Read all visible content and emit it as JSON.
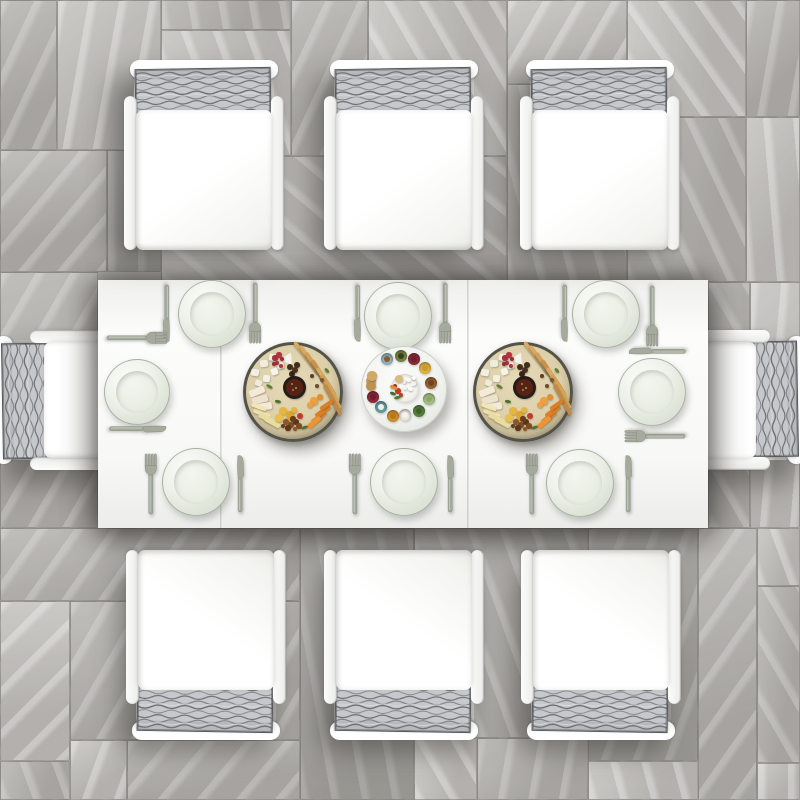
{
  "alt": "Top-down photo of a white aluminum outdoor dining set on gray stone tile: rectangular white table, eight chairs with white seat cushions and gray woven back cushions, eight pale sage dinner plates with forks and knives, two round charcuterie boards and a central snack platter with small bowls",
  "palette": {
    "floor_light": "#c1bfbb",
    "floor_mid": "#b2b0ac",
    "floor_dark": "#a19f9b",
    "seam": "#767470",
    "table_white": "#f8f8f6",
    "chair_white": "#fcfcfa",
    "cushion_gray": "#c4c6c9",
    "cushion_line": "#6a6d72",
    "plate_sage": "#e3e8dd",
    "cutlery_metal": "#a5aa9d",
    "board_rim": "#53534a",
    "breadstick": "#d9aa63",
    "cheese_white": "#f2efe4",
    "berry_red": "#a83040",
    "date_brown": "#422b1b",
    "chutney": "#5a2115",
    "dried_yellow": "#e5b53e",
    "nut_brown": "#7c4b24",
    "carrot_orange": "#e78a2d",
    "leaf_green": "#5d7c36"
  },
  "floor": {
    "tiles": [
      [
        0,
        0,
        57,
        150,
        1,
        115
      ],
      [
        57,
        0,
        104,
        150,
        0,
        100
      ],
      [
        161,
        0,
        130,
        30,
        1,
        80
      ],
      [
        161,
        30,
        130,
        126,
        0,
        70
      ],
      [
        291,
        0,
        77,
        156,
        1,
        115
      ],
      [
        368,
        0,
        139,
        156,
        0,
        60
      ],
      [
        0,
        150,
        107,
        122,
        1,
        130
      ],
      [
        107,
        150,
        54,
        122,
        2,
        90
      ],
      [
        161,
        156,
        346,
        126,
        1,
        40
      ],
      [
        507,
        0,
        120,
        84,
        0,
        120
      ],
      [
        507,
        84,
        120,
        198,
        1,
        75
      ],
      [
        627,
        0,
        119,
        117,
        0,
        55
      ],
      [
        746,
        0,
        54,
        117,
        1,
        100
      ],
      [
        627,
        117,
        119,
        165,
        1,
        65
      ],
      [
        746,
        117,
        54,
        165,
        0,
        85
      ],
      [
        0,
        272,
        98,
        256,
        1,
        120
      ],
      [
        708,
        282,
        42,
        246,
        1,
        60
      ],
      [
        750,
        282,
        50,
        246,
        0,
        95
      ],
      [
        0,
        528,
        300,
        73,
        1,
        125
      ],
      [
        300,
        528,
        114,
        272,
        2,
        80
      ],
      [
        414,
        528,
        174,
        210,
        1,
        70
      ],
      [
        588,
        528,
        110,
        233,
        2,
        110
      ],
      [
        698,
        528,
        59,
        272,
        1,
        125
      ],
      [
        757,
        528,
        43,
        58,
        0,
        70
      ],
      [
        757,
        586,
        43,
        177,
        1,
        60
      ],
      [
        757,
        763,
        43,
        37,
        0,
        90
      ],
      [
        0,
        601,
        70,
        160,
        0,
        135
      ],
      [
        70,
        601,
        230,
        139,
        1,
        120
      ],
      [
        0,
        761,
        70,
        39,
        1,
        70
      ],
      [
        70,
        740,
        57,
        60,
        0,
        110
      ],
      [
        127,
        740,
        173,
        60,
        1,
        130
      ],
      [
        414,
        738,
        63,
        62,
        0,
        60
      ],
      [
        477,
        738,
        111,
        62,
        1,
        100
      ],
      [
        588,
        761,
        110,
        39,
        0,
        75
      ]
    ]
  },
  "table": {
    "x": 98,
    "y": 280,
    "w": 610,
    "h": 248,
    "seam_offsets": [
      122,
      369
    ]
  },
  "chairs": {
    "top": [
      {
        "x": 124,
        "y": 60,
        "sh": [
          -16,
          12
        ]
      },
      {
        "x": 324,
        "y": 60,
        "sh": [
          -12,
          12
        ]
      },
      {
        "x": 520,
        "y": 60,
        "sh": [
          -14,
          12
        ]
      }
    ],
    "bottom": [
      {
        "x": 126,
        "y": 548,
        "sh": [
          -10,
          -16
        ]
      },
      {
        "x": 324,
        "y": 548,
        "sh": [
          -8,
          -16
        ]
      },
      {
        "x": 521,
        "y": 548,
        "sh": [
          -10,
          -16
        ]
      }
    ],
    "ends": [
      {
        "x": 19,
        "y": 305,
        "rot": -90,
        "sh": [
          -18,
          6
        ]
      },
      {
        "x": 641,
        "y": 305,
        "rot": 90,
        "sh": [
          18,
          6
        ]
      }
    ]
  },
  "plates": [
    [
      212,
      314,
      34
    ],
    [
      398,
      316,
      34
    ],
    [
      606,
      314,
      34
    ],
    [
      196,
      482,
      34
    ],
    [
      404,
      482,
      34
    ],
    [
      580,
      483,
      34
    ],
    [
      137,
      392,
      33
    ],
    [
      652,
      392,
      34
    ]
  ],
  "cutlery": [
    [
      "knife",
      166,
      313,
      180
    ],
    [
      "fork",
      255,
      313,
      180
    ],
    [
      "knife",
      357,
      313,
      180
    ],
    [
      "fork",
      445,
      313,
      180
    ],
    [
      "knife",
      564,
      313,
      180
    ],
    [
      "fork",
      652,
      316,
      180
    ],
    [
      "fork",
      151,
      484,
      0
    ],
    [
      "knife",
      240,
      484,
      0
    ],
    [
      "fork",
      355,
      484,
      0
    ],
    [
      "knife",
      450,
      484,
      0
    ],
    [
      "fork",
      532,
      484,
      0
    ],
    [
      "knife",
      628,
      484,
      0
    ],
    [
      "fork",
      137,
      338,
      90
    ],
    [
      "knife",
      137,
      429,
      90
    ],
    [
      "knife",
      657,
      351,
      -90
    ],
    [
      "fork",
      655,
      436,
      -90
    ]
  ],
  "platters": {
    "boards": [
      [
        293,
        392,
        50
      ],
      [
        523,
        392,
        50
      ]
    ],
    "center": {
      "x": 404,
      "y": 389,
      "r": 43,
      "dish": {
        "dx": 1,
        "dy": -1,
        "r": 14
      }
    }
  },
  "board_items": [
    [
      "r",
      "#d9aa63",
      14,
      -34,
      40,
      3.5,
      52
    ],
    [
      "r",
      "#d9aa63",
      20,
      -28,
      44,
      3.5,
      55
    ],
    [
      "r",
      "#d2a159",
      26,
      -21,
      44,
      3.5,
      55
    ],
    [
      "r",
      "#c8924b",
      31,
      -14,
      42,
      3.5,
      57
    ],
    [
      "r",
      "#d9aa63",
      35,
      -7,
      40,
      3.5,
      58
    ],
    [
      "r",
      "#cfa055",
      38,
      0,
      38,
      3.5,
      60
    ],
    [
      "r",
      "#c08a46",
      40,
      8,
      34,
      3.5,
      62
    ],
    [
      "c",
      "#6d4a28",
      24,
      -6,
      2.2,
      0,
      0
    ],
    [
      "c",
      "#7a5530",
      29,
      -12,
      2,
      0,
      0
    ],
    [
      "c",
      "#5f3c1e",
      19,
      -16,
      2,
      0,
      0
    ],
    [
      "r",
      "#f2efe4",
      -38,
      -20,
      8,
      7,
      10
    ],
    [
      "r",
      "#efece0",
      -29,
      -29,
      8,
      7,
      -8
    ],
    [
      "r",
      "#f4f1e6",
      -20,
      -35,
      8,
      7,
      14
    ],
    [
      "r",
      "#eeebdf",
      -13,
      -27,
      7,
      7,
      -14
    ],
    [
      "r",
      "#f2efe4",
      -27,
      -14,
      7,
      7,
      4
    ],
    [
      "r",
      "#f6f3e8",
      -19,
      -21,
      7,
      7,
      -20
    ],
    [
      "r",
      "#eeebdf",
      -35,
      -9,
      7,
      6,
      18
    ],
    [
      "t",
      "#f6f3ea",
      -5,
      -35,
      13,
      11,
      25
    ],
    [
      "c",
      "#a83040",
      -18,
      -34,
      2.6,
      0,
      0
    ],
    [
      "c",
      "#b13545",
      -14,
      -37,
      2.6,
      0,
      0
    ],
    [
      "c",
      "#9c2a38",
      -11,
      -33,
      2.4,
      0,
      0
    ],
    [
      "c",
      "#a83040",
      -16,
      -29,
      2.4,
      0,
      0
    ],
    [
      "c",
      "#b13545",
      -12,
      -26,
      2.2,
      0,
      0
    ],
    [
      "c",
      "#9c2a38",
      -19,
      -28,
      2.2,
      0,
      0
    ],
    [
      "c",
      "#422b1b",
      -3,
      -25,
      3.4,
      0,
      0
    ],
    [
      "c",
      "#4c3120",
      2,
      -22,
      3.2,
      0,
      0
    ],
    [
      "c",
      "#382416",
      -1,
      -18,
      3,
      0,
      0
    ],
    [
      "c",
      "#422b1b",
      4,
      -27,
      2.8,
      0,
      0
    ],
    [
      "c",
      "#241d17",
      1,
      -5,
      11.5,
      0,
      0
    ],
    [
      "c",
      "#5a2115",
      1,
      -5,
      8.5,
      0,
      0
    ],
    [
      "c",
      "#7f9c4a",
      -1,
      -8,
      1.2,
      0,
      0
    ],
    [
      "c",
      "#8fab55",
      3,
      -4,
      1.2,
      0,
      0
    ],
    [
      "c",
      "#7f9c4a",
      0,
      -2,
      1,
      0,
      0
    ],
    [
      "r",
      "#f3ead9",
      -36,
      -1,
      16,
      7,
      -22
    ],
    [
      "r",
      "#eee2cf",
      -33,
      7,
      16,
      7,
      -14
    ],
    [
      "r",
      "#f3ead9",
      -29,
      14,
      15,
      7,
      -8
    ],
    [
      "r",
      "#efe3ab",
      -31,
      21,
      18,
      4.5,
      24
    ],
    [
      "r",
      "#e9dca0",
      -26,
      26,
      18,
      4.5,
      26
    ],
    [
      "r",
      "#f2e6b2",
      -34,
      15,
      16,
      4,
      20
    ],
    [
      "r",
      "#e9dca0",
      -21,
      30,
      17,
      4.5,
      28
    ],
    [
      "c",
      "#e5b53e",
      -10,
      19,
      4,
      0,
      0
    ],
    [
      "c",
      "#dca832",
      -3,
      23,
      4,
      0,
      0
    ],
    [
      "c",
      "#eabf4a",
      -14,
      26,
      3.6,
      0,
      0
    ],
    [
      "c",
      "#dca832",
      -6,
      29,
      3.4,
      0,
      0
    ],
    [
      "c",
      "#e5b53e",
      1,
      18,
      3.2,
      0,
      0
    ],
    [
      "c",
      "#7c4b24",
      -2,
      33,
      3,
      0,
      0
    ],
    [
      "c",
      "#5f3418",
      3,
      30,
      2.8,
      0,
      0
    ],
    [
      "c",
      "#8a562c",
      -7,
      30,
      2.8,
      0,
      0
    ],
    [
      "c",
      "#6b3d1d",
      0,
      27,
      2.6,
      0,
      0
    ],
    [
      "c",
      "#7c4b24",
      6,
      34,
      2.6,
      0,
      0
    ],
    [
      "c",
      "#5f3418",
      -5,
      36,
      2.6,
      0,
      0
    ],
    [
      "c",
      "#8a562c",
      2,
      37,
      2.4,
      0,
      0
    ],
    [
      "c",
      "#6b3d1d",
      -10,
      34,
      2.4,
      0,
      0
    ],
    [
      "r",
      "#e78a2d",
      25,
      25,
      17,
      4.5,
      -38
    ],
    [
      "r",
      "#db7f24",
      29,
      19,
      17,
      4.5,
      -36
    ],
    [
      "r",
      "#ef9433",
      21,
      30,
      16,
      4.5,
      -40
    ],
    [
      "r",
      "#db7f24",
      33,
      13,
      15,
      4,
      -34
    ],
    [
      "c",
      "#ef9f3f",
      21,
      9,
      3.6,
      0,
      0
    ],
    [
      "c",
      "#e2902f",
      27,
      5,
      3.4,
      0,
      0
    ],
    [
      "c",
      "#ef9f3f",
      17,
      13,
      3.2,
      0,
      0
    ],
    [
      "c",
      "#c0392b",
      7,
      24,
      3,
      0,
      0
    ],
    [
      "l",
      "#5d7c36",
      -24,
      -6,
      7,
      3,
      30
    ],
    [
      "l",
      "#52702f",
      11,
      35,
      7,
      3,
      -20
    ],
    [
      "l",
      "#5d7c36",
      34,
      -22,
      6,
      3,
      50
    ],
    [
      "l",
      "#52702f",
      -15,
      9,
      6,
      2.5,
      10
    ]
  ],
  "center_bowls": [
    [
      "#8fb0bb",
      -17,
      -30,
      "#8a5a30"
    ],
    [
      "#75823f",
      -3,
      -33,
      "#3a3d22"
    ],
    [
      "#8a2a3a",
      10,
      -30,
      "#6e1f2c"
    ],
    [
      "#e0b23c",
      21,
      -21,
      "#c89a28"
    ],
    [
      "#96622f",
      27,
      -6,
      "#6e4520"
    ],
    [
      "#a4bd85",
      25,
      10,
      "#8aa868"
    ],
    [
      "#55803c",
      15,
      22,
      "#3f6129"
    ],
    [
      "#e8e6df",
      1,
      26,
      "#f4f2ea"
    ],
    [
      "#d28d2c",
      -11,
      27,
      "#b87718"
    ],
    [
      "#679aa0",
      -23,
      18,
      "#eef0ea"
    ],
    [
      "#8a2a3a",
      -31,
      8,
      "#6e1f2c"
    ]
  ],
  "center_loose_items": [
    [
      "c",
      "#c79e5c",
      -33,
      -8,
      5,
      0,
      0
    ],
    [
      "c",
      "#bd9251",
      -33,
      -3,
      5,
      0,
      0
    ],
    [
      "c",
      "#cfa967",
      -32,
      -13,
      4.6,
      0,
      0
    ]
  ],
  "dish_items": [
    [
      "r",
      "#fbfaf6",
      4,
      -7,
      5,
      4,
      10
    ],
    [
      "r",
      "#f6f4ee",
      9,
      -3,
      5,
      4,
      -12
    ],
    [
      "r",
      "#fbfaf6",
      6,
      2,
      5,
      4,
      22
    ],
    [
      "r",
      "#f2f0e8",
      0,
      -5,
      4,
      4,
      -6
    ],
    [
      "r",
      "#fbfaf6",
      10,
      -9,
      4,
      4,
      30
    ],
    [
      "r",
      "#f6f4ee",
      1,
      1,
      4,
      4,
      8
    ],
    [
      "c",
      "#c43a2a",
      -6,
      4,
      2.6,
      0,
      0
    ],
    [
      "c",
      "#b53322",
      -9,
      -1,
      2.4,
      0,
      0
    ],
    [
      "c",
      "#c43a2a",
      -3,
      8,
      2.2,
      0,
      0
    ],
    [
      "l",
      "#4e7a33",
      -7,
      10,
      7,
      3,
      -15
    ],
    [
      "l",
      "#446b2b",
      -11,
      6,
      6,
      2.6,
      20
    ],
    [
      "c",
      "#d9bc82",
      -5,
      -8,
      4,
      0,
      0
    ],
    [
      "r",
      "#e08a3a",
      -10,
      0,
      8,
      2.5,
      25
    ]
  ]
}
